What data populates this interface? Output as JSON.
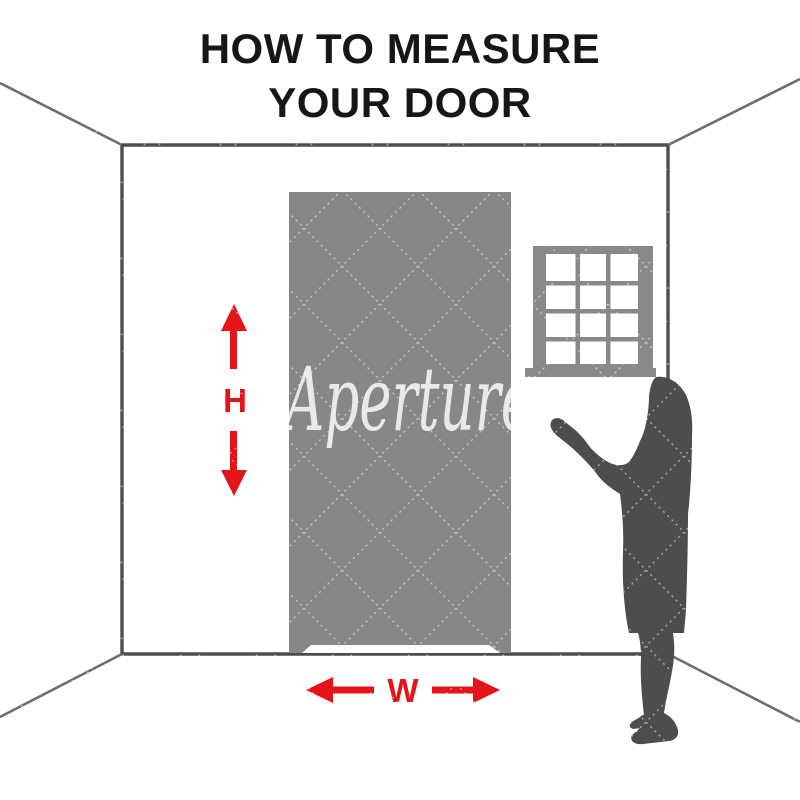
{
  "title": {
    "line1": "HOW TO MEASURE",
    "line2": "YOUR DOOR"
  },
  "measurements": {
    "height_label": "H",
    "width_label": "W"
  },
  "watermark": {
    "text": "Aperture"
  },
  "icons": {
    "height_arrow_up": "arrow-up",
    "height_arrow_down": "arrow-down",
    "width_arrow_left": "arrow-left",
    "width_arrow_right": "arrow-right"
  },
  "colors": {
    "arrow_red": "#e41419",
    "door_gray": "#878787",
    "window_gray": "#898989",
    "silhouette_gray": "#4d4d4d",
    "wall_line_gray": "#4d4d4d",
    "corner_line_gray": "#6e6e6e",
    "title_color": "#161616",
    "watermark_white": "#ffffff"
  }
}
